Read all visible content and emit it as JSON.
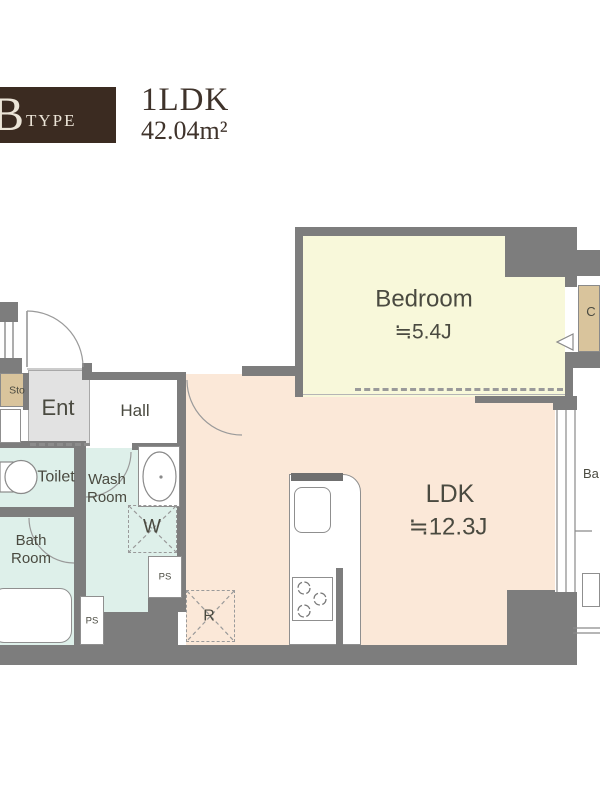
{
  "header": {
    "type_letter": "B",
    "type_word": "TYPE",
    "plan_type": "1LDK",
    "area": "42.04m²"
  },
  "labels": {
    "bedroom_name": "Bedroom",
    "bedroom_size": "≒5.4J",
    "ldk_name": "LDK",
    "ldk_size": "≒12.3J",
    "entrance": "Ent",
    "hall": "Hall",
    "toilet": "Toilet",
    "wash_line1": "Wash",
    "wash_line2": "Room",
    "bath_line1": "Bath",
    "bath_line2": "Room",
    "storage": "Sto",
    "closet": "C",
    "balcony": "Ba",
    "washing_machine": "W",
    "refrigerator": "R",
    "pipe_space_upper": "PS",
    "pipe_space_lower": "PS"
  },
  "colors": {
    "wall": "#7d7d7d",
    "bedroom": "#f8f8da",
    "ldk": "#fbe8d8",
    "water": "#def0ea",
    "closet_tan": "#d9c49c",
    "entrance": "#e2e2e2",
    "header_bg": "#3b2b21",
    "header_text": "#ece5d8",
    "title_text": "#3f332b",
    "label_text": "#4a4a40"
  }
}
